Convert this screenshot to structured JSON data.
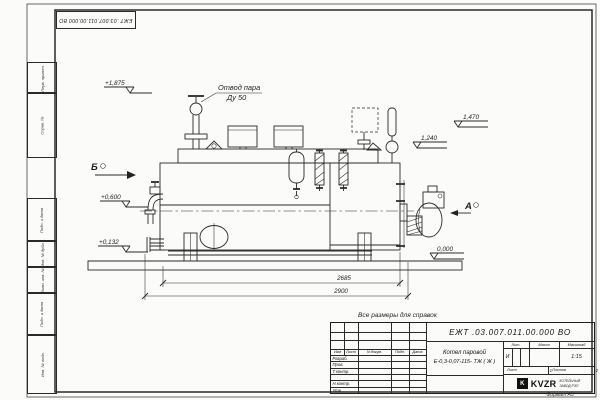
{
  "sheet": {
    "stamp_top": "ЕЖТ .03.007.011.00.000  ВО",
    "side_labels": [
      "Перв. примен.",
      "Справ. №",
      "Подп. и дата",
      "Инв. № дубл.",
      "Взам. инв. №",
      "Подп. и дата",
      "Инв. № подл."
    ],
    "format_note": "Формат А3"
  },
  "drawing": {
    "note": "Все размеры для справок",
    "callouts": {
      "steam_line1": "Отвод пара",
      "steam_line2": "Ду 50"
    },
    "views": {
      "a": "А",
      "b": "Б"
    },
    "elevations": {
      "top": "+1,875",
      "right_upper": "1,470",
      "right_mid": "1,240",
      "left_mid": "+0,600",
      "left_low": "+0,132",
      "ground": "0,000"
    },
    "dimensions": {
      "length_inner": "2685",
      "length_overall": "2900"
    }
  },
  "title_block": {
    "doc_number": "ЕЖТ .03.007.011.00.000  ВО",
    "product_name_1": "Котел паровой",
    "product_name_2": "Е-0,3-0,07-115- ТЖ ( Ж )",
    "cols": {
      "izm": "Изм",
      "list": "Лист",
      "doc": "N докум.",
      "sign": "Подп.",
      "date": "Дата"
    },
    "rows": {
      "developed": "Разраб.",
      "checked": "Пров.",
      "tcontrol": "Т.контр.",
      "ncontrol": "Н.контр.",
      "approved": "Утв."
    },
    "lit_label": "Лит.",
    "lit_value": "И",
    "mass_label": "Масса",
    "scale_label": "Масштаб",
    "scale_value": "1:15",
    "sheet_label": "Лист",
    "sheet_value": "1",
    "sheets_label": "Листов",
    "sheets_value": "2",
    "company": {
      "logo": "K",
      "name": "KVZR",
      "line1": "КОТЕЛЬНЫЙ",
      "line2": "ЗАВОД РЭП"
    }
  }
}
